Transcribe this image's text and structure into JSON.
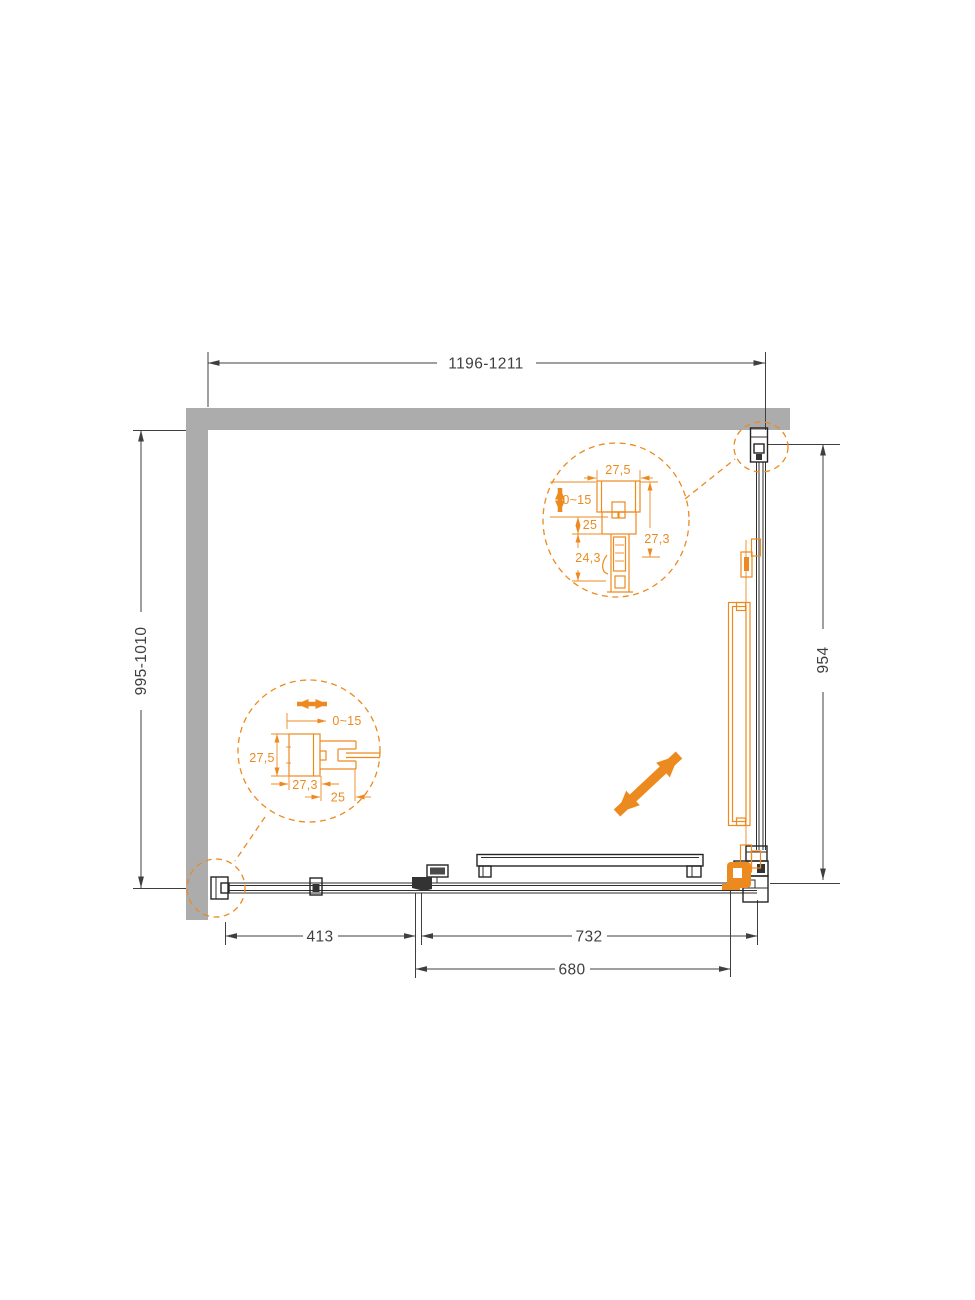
{
  "dimensions": {
    "top_width": "1196-1211",
    "left_height": "995-1010",
    "side_height": "954",
    "fixed_panel": "413",
    "door_opening": "732",
    "door_glass": "680"
  },
  "detail_top_profile": {
    "profile_width": "27,5",
    "wall_adjustment": "0~15",
    "dim_25": "25",
    "dim_24_3": "24,3",
    "dim_27_3": "27,3"
  },
  "detail_side_profile": {
    "wall_adjustment": "0~15",
    "profile_height": "27,5",
    "dim_27_3": "27,3",
    "dim_25": "25"
  },
  "colors": {
    "accent": "#ED8A1F",
    "wall": "#ACACAC",
    "line": "#3F3F3F"
  }
}
